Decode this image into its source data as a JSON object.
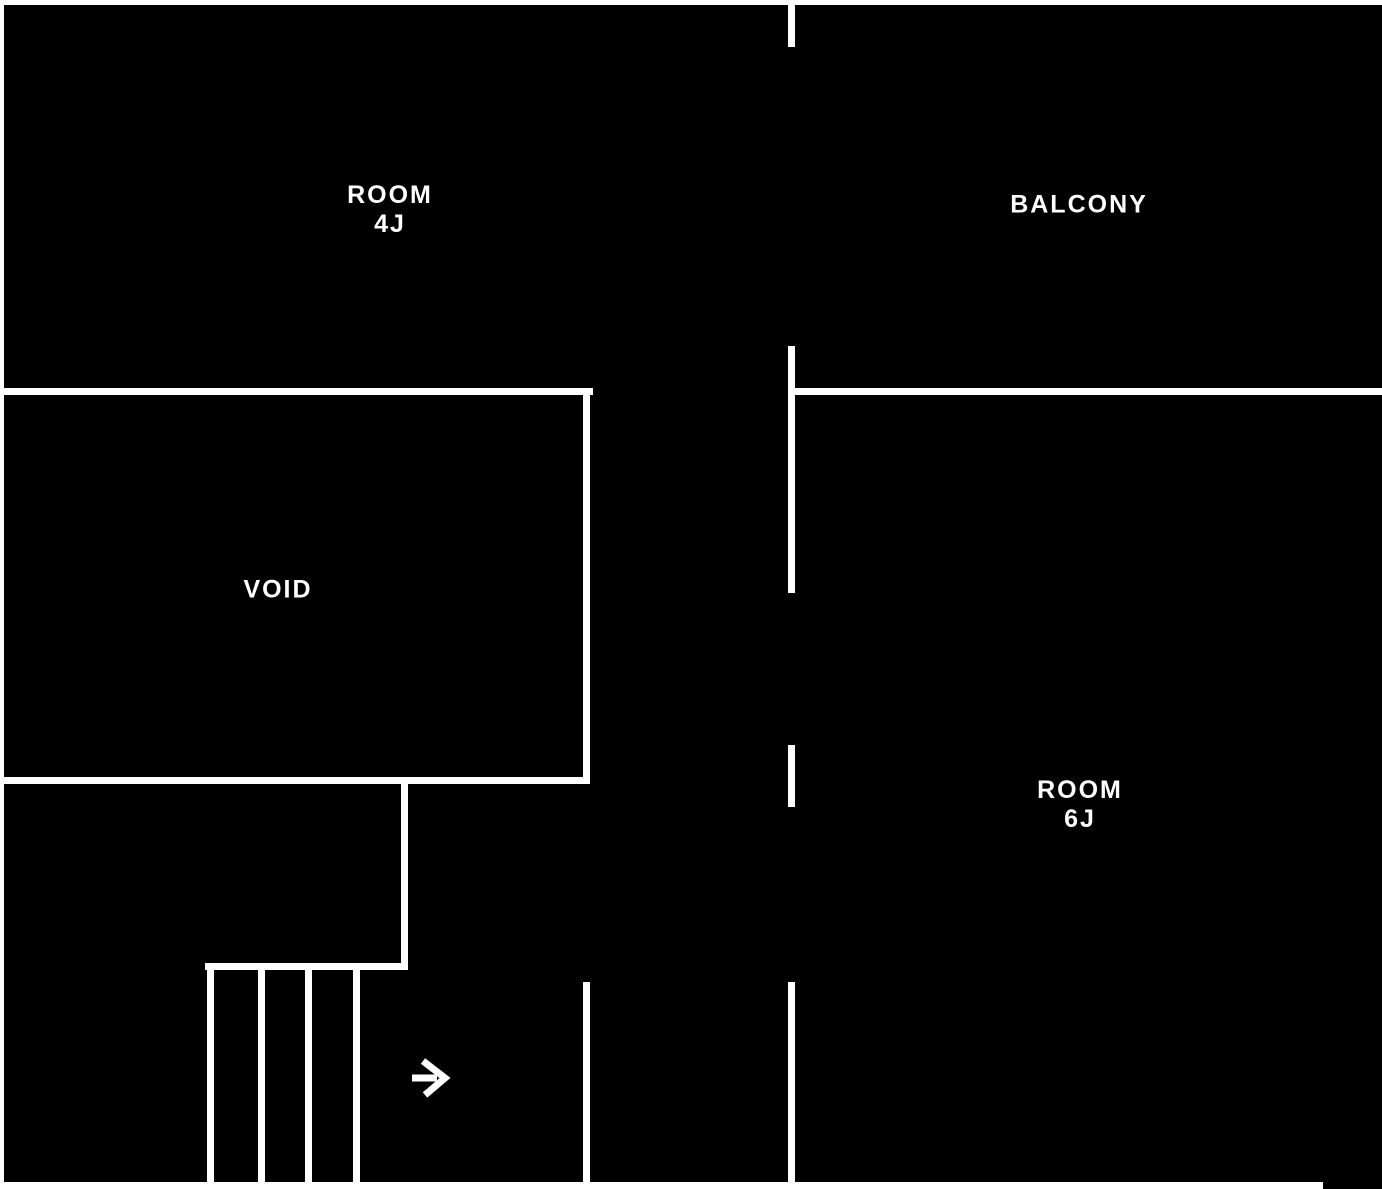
{
  "plan": {
    "background_color": "#000000",
    "wall_color": "#ffffff",
    "text_color": "#ffffff",
    "labels": {
      "room_4j": {
        "text": "ROOM\n4J"
      },
      "balcony": {
        "text": "BALCONY"
      },
      "void": {
        "text": "VOID"
      },
      "room_6j": {
        "text": "ROOM\n6J"
      }
    },
    "arrow": {
      "name": "entry-direction-arrow",
      "direction": "right"
    },
    "walls": [
      {
        "name": "border-top",
        "x": 0,
        "y": 0,
        "w": 1382,
        "h": 5
      },
      {
        "name": "border-left",
        "x": 0,
        "y": 0,
        "w": 4,
        "h": 1189
      },
      {
        "name": "border-bottom",
        "x": 0,
        "y": 1182,
        "w": 1323,
        "h": 7
      },
      {
        "name": "mid-wall-top-segment",
        "x": 788,
        "y": 5,
        "w": 7,
        "h": 42
      },
      {
        "name": "mid-wall-upper-segment",
        "x": 788,
        "y": 346,
        "w": 7,
        "h": 247
      },
      {
        "name": "mid-wall-lower-segment",
        "x": 788,
        "y": 745,
        "w": 7,
        "h": 62
      },
      {
        "name": "mid-wall-bottom-segment",
        "x": 788,
        "y": 982,
        "w": 7,
        "h": 207
      },
      {
        "name": "room-4j-bottom-wall",
        "x": 0,
        "y": 388,
        "w": 593,
        "h": 7
      },
      {
        "name": "room-6j-top-wall",
        "x": 788,
        "y": 388,
        "w": 594,
        "h": 7
      },
      {
        "name": "void-right-wall",
        "x": 583,
        "y": 388,
        "w": 7,
        "h": 395
      },
      {
        "name": "void-bottom-wall",
        "x": 0,
        "y": 777,
        "w": 590,
        "h": 7
      },
      {
        "name": "landing-right-wall",
        "x": 401,
        "y": 783,
        "w": 7,
        "h": 186
      },
      {
        "name": "stairs-top-wall",
        "x": 205,
        "y": 963,
        "w": 203,
        "h": 7
      },
      {
        "name": "stair-tread-line-1",
        "x": 207,
        "y": 969,
        "w": 7,
        "h": 213
      },
      {
        "name": "stair-tread-line-2",
        "x": 258,
        "y": 969,
        "w": 7,
        "h": 213
      },
      {
        "name": "stair-tread-line-3",
        "x": 305,
        "y": 969,
        "w": 7,
        "h": 213
      },
      {
        "name": "stair-tread-line-4",
        "x": 353,
        "y": 969,
        "w": 7,
        "h": 213
      },
      {
        "name": "corridor-left-wall",
        "x": 583,
        "y": 982,
        "w": 7,
        "h": 207
      }
    ]
  }
}
